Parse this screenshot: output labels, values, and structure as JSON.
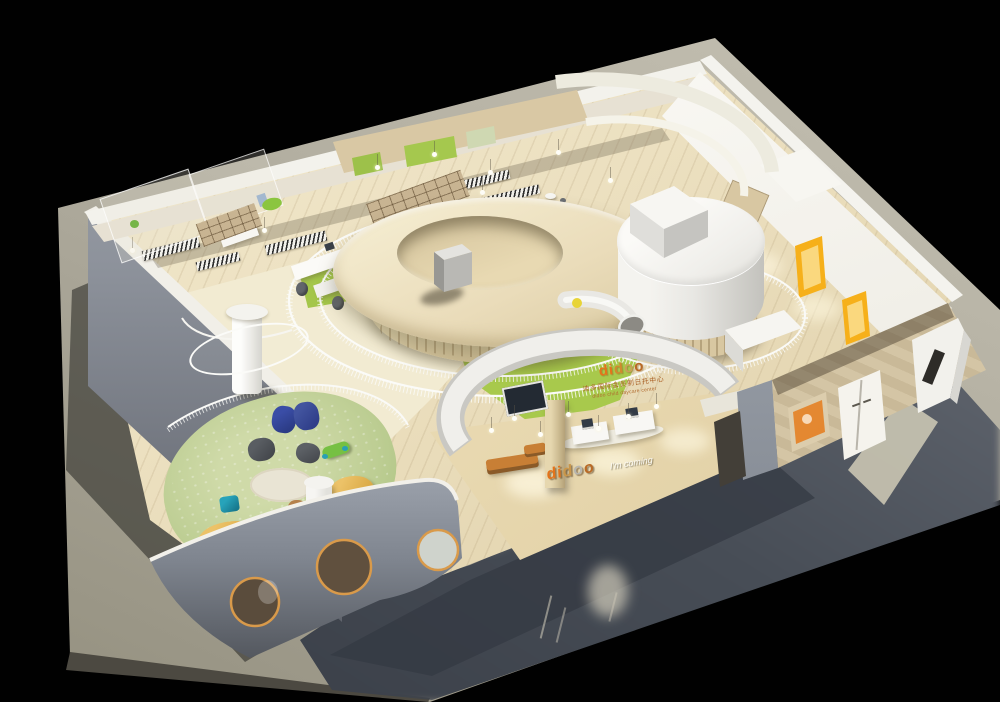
{
  "branding": {
    "logo_letters": [
      "d",
      "i",
      "d",
      "o",
      "o"
    ],
    "wall_sign": {
      "logo": "didoo",
      "tagline_cn": "迪多国际会员制日托中心",
      "tagline_en": "didoo child daycare center"
    },
    "entrance_floor_sign": {
      "logo": "didoo",
      "slogan": "I'm coming"
    }
  },
  "palette": {
    "background": "#010101",
    "platform_light": "#bcb8aa",
    "platform_shadow": "#434851",
    "wall_white": "#f3f2ed",
    "wall_gray": "#8d939d",
    "wood_floor": "#e9dcba",
    "cream_floor": "#f1ead0",
    "play_green": "#a8c94c",
    "courtyard_green": "#bfd096",
    "donut_cream": "#eee3c2",
    "accent_orange_door": "#f5ae19",
    "logo_orange": "#e4731b",
    "logo_tan": "#c9a158",
    "logo_brown": "#b96a26",
    "beanbag_navy": "#2c3c86",
    "beanbag_teal": "#1f95ac",
    "lounger_yellow": "#e0b050"
  }
}
